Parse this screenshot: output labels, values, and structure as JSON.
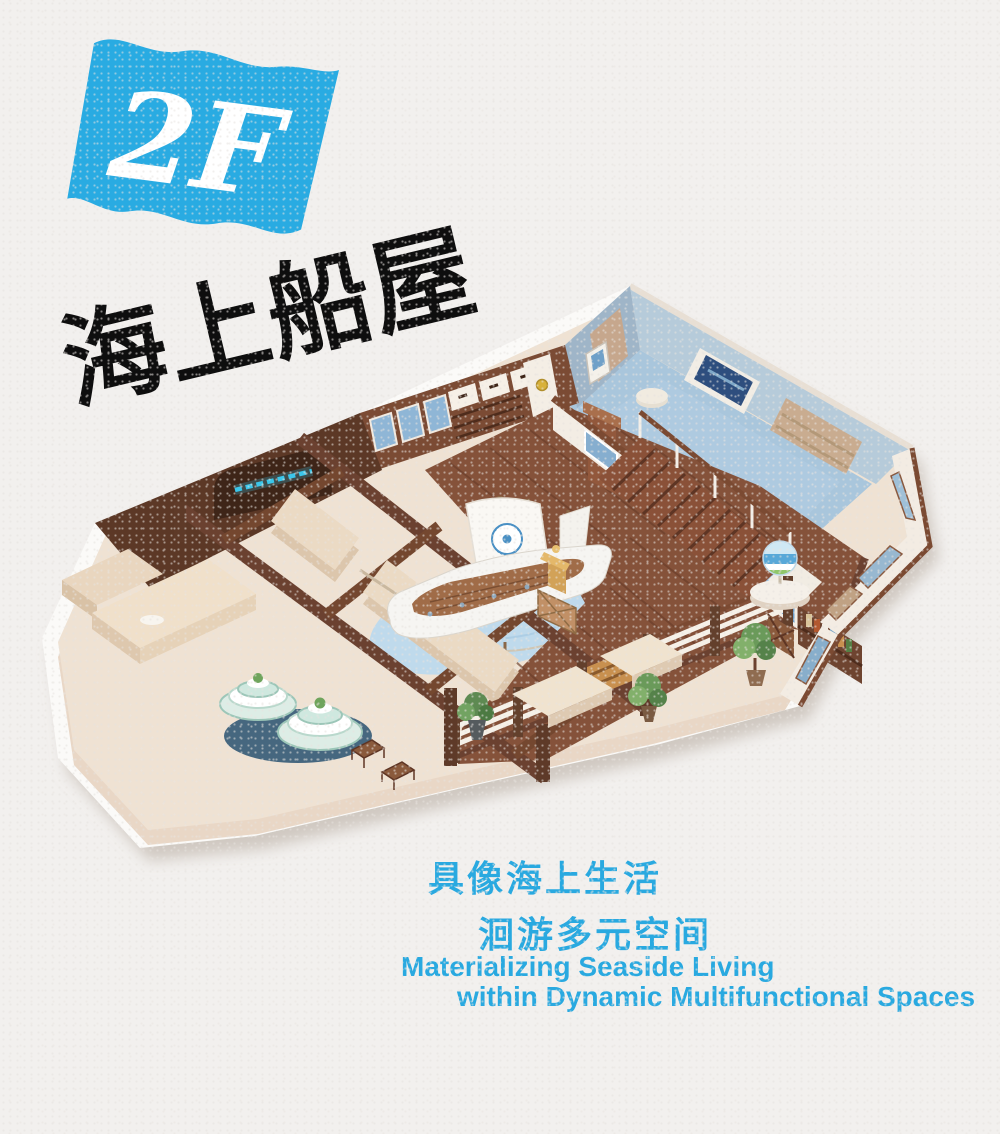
{
  "badge": {
    "label": "2F",
    "color": "#29abe2",
    "text_color": "#ffffff"
  },
  "title": {
    "text": "海上船屋",
    "color": "#0e0e0e"
  },
  "tagline": {
    "cn_line1": "具像海上生活",
    "cn_line2": "洄游多元空间",
    "en_line1": "Materializing Seaside Living",
    "en_line2": "within Dynamic Multifunctional Spaces",
    "color": "#29a9e0"
  },
  "colors": {
    "paper": "#f2f0ee",
    "accent_blue": "#29abe2",
    "floor_cream": "#efe2d3",
    "deck_brown": "#85523a",
    "wall_dark_brown": "#5c3826",
    "blue_room_floor": "#a9c6dc",
    "water_blue": "#bfdaec"
  },
  "floorplan": {
    "alt": "Isometric cutaway floor plan of the 2F sea boat-house exhibition space with wooden deck, boat display, stairs and blue classroom"
  }
}
